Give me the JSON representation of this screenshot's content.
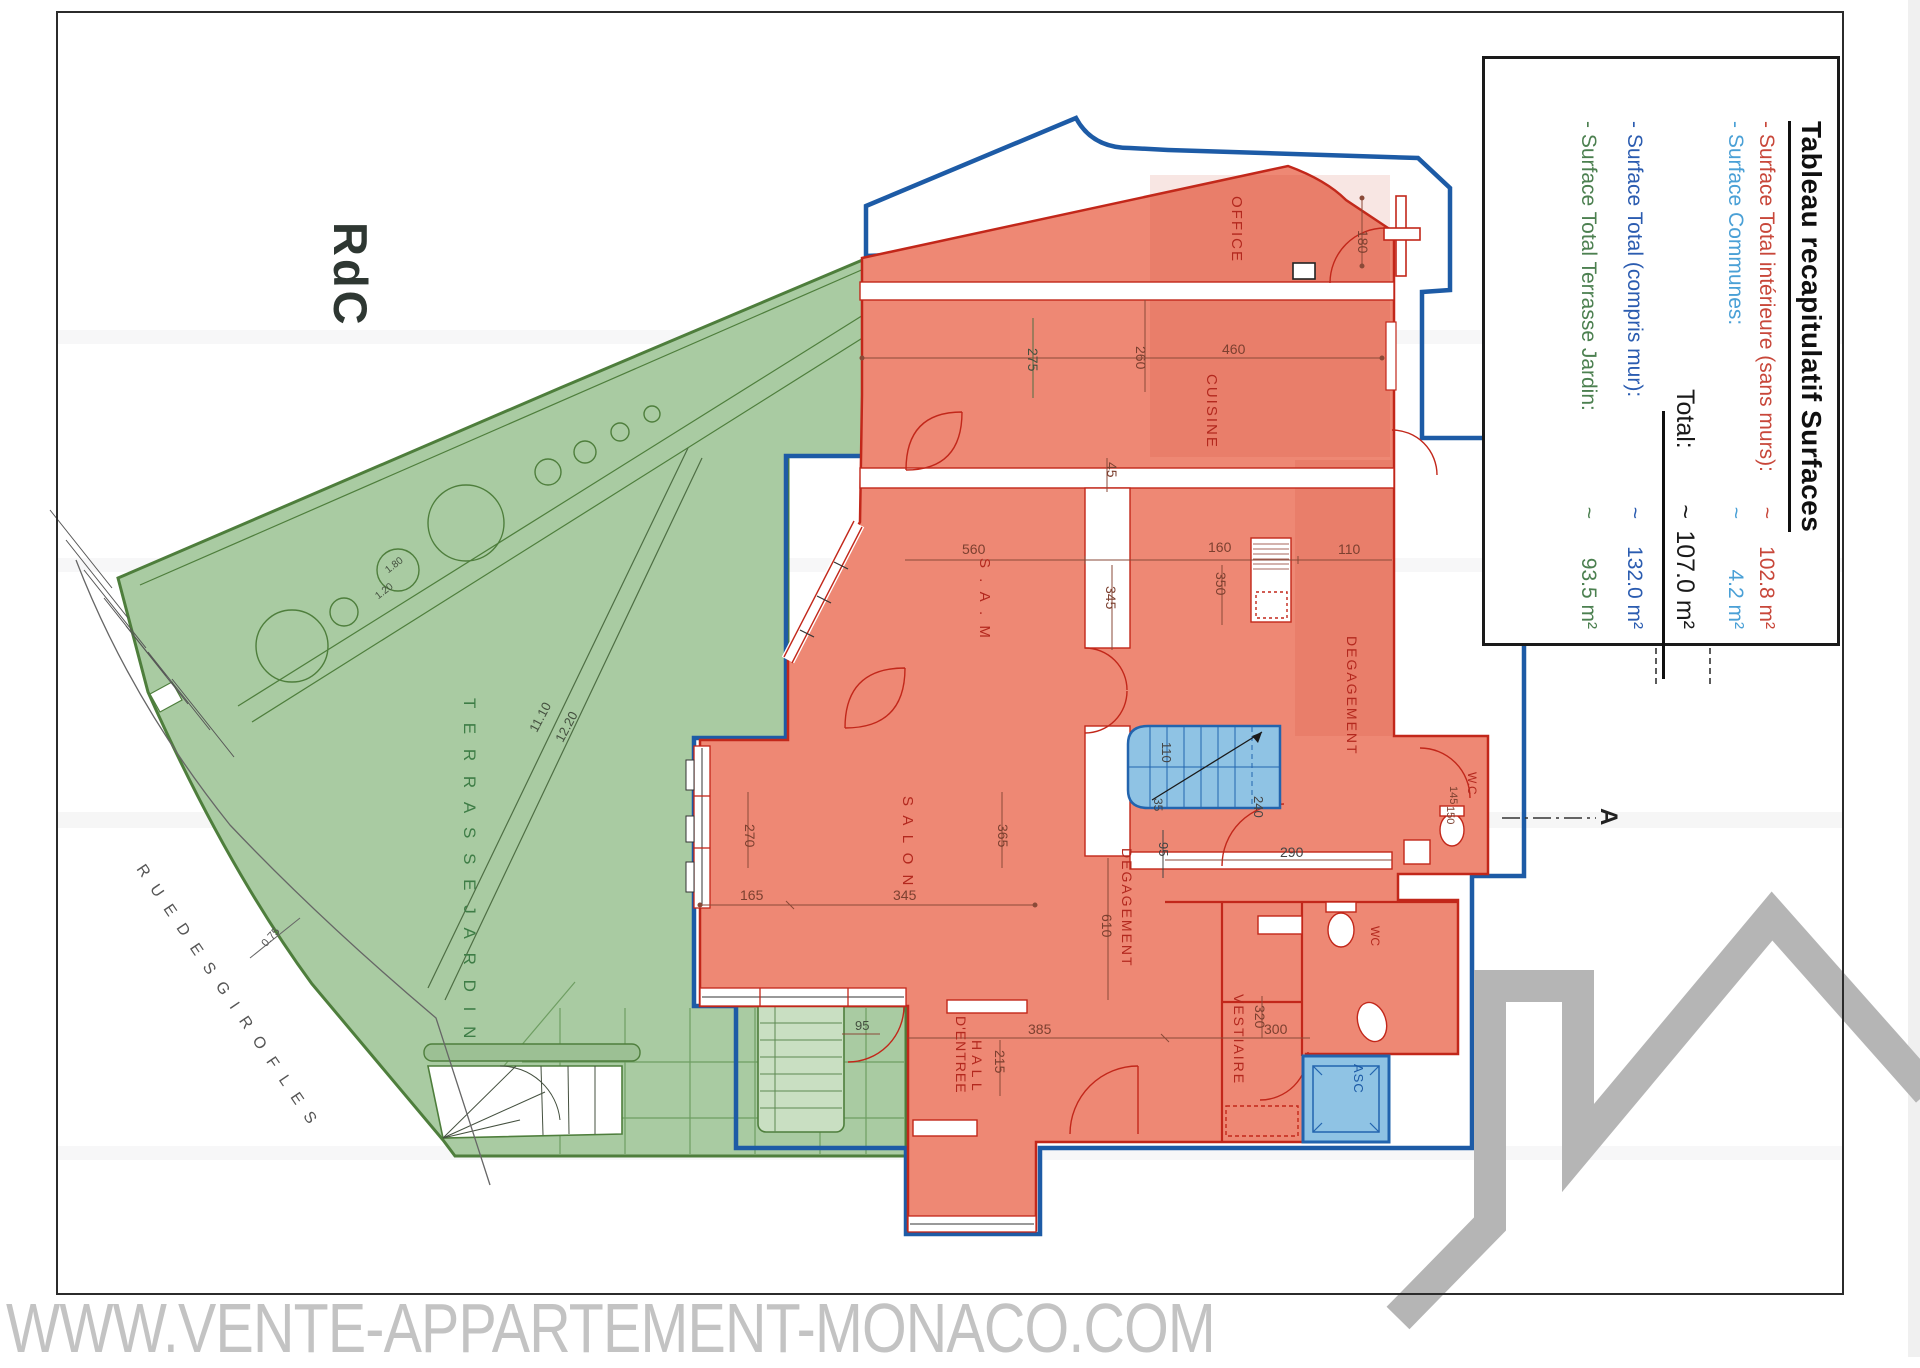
{
  "page": {
    "rdc_label": "RdC",
    "watermark": "WWW.VENTE-APPARTEMENT-MONACO.COM"
  },
  "legend": {
    "title": "Tableau recapitulatif Surfaces",
    "rows": [
      {
        "label": "- Surface Total intérieure (sans murs):",
        "approx": "~",
        "value": "102.8 m²",
        "color": "#c8473a"
      },
      {
        "label": "- Surface Communes:",
        "approx": "~",
        "value": "4.2 m²",
        "color": "#4aa0d6"
      },
      {
        "label": "Total:",
        "approx": "~",
        "value": "107.0 m²",
        "color": "#1a1a1a"
      },
      {
        "label": "- Surface Total (compris mur):",
        "approx": "~",
        "value": "132.0 m²",
        "color": "#2b5cb0"
      },
      {
        "label": "- Surface Total Terrasse Jardin:",
        "approx": "~",
        "value": "93.5 m²",
        "color": "#4c8050"
      }
    ]
  },
  "plan": {
    "labels": [
      {
        "id": "room-office",
        "t": "OFFICE",
        "x": 1244,
        "y": 196,
        "r": 90,
        "s": 15,
        "c": "#b3281e",
        "ls": 2
      },
      {
        "id": "room-cuisine",
        "t": "CUISINE",
        "x": 1219,
        "y": 374,
        "r": 90,
        "s": 15,
        "c": "#b3281e",
        "ls": 2
      },
      {
        "id": "room-sam",
        "t": "S . A . M",
        "x": 992,
        "y": 558,
        "r": 90,
        "s": 15,
        "c": "#b3281e",
        "ls": 3
      },
      {
        "id": "room-salon",
        "t": "S A L O N",
        "x": 915,
        "y": 796,
        "r": 90,
        "s": 15,
        "c": "#b3281e",
        "ls": 3
      },
      {
        "id": "room-degagement-right",
        "t": "DEGAGEMENT",
        "x": 1359,
        "y": 636,
        "r": 90,
        "s": 14,
        "c": "#b3281e",
        "ls": 2
      },
      {
        "id": "room-degagement-bottom",
        "t": "DEGAGEMENT",
        "x": 1134,
        "y": 848,
        "r": 90,
        "s": 14,
        "c": "#b3281e",
        "ls": 2
      },
      {
        "id": "dim-610",
        "t": "610",
        "x": 1114,
        "y": 914,
        "r": 90,
        "s": 14,
        "c": "#7c4030"
      },
      {
        "id": "room-hall",
        "t": "H A L L",
        "x": 984,
        "y": 1040,
        "r": 90,
        "s": 14,
        "c": "#b3281e",
        "ls": 1
      },
      {
        "id": "room-hall-entree",
        "t": "D'ENTREE",
        "x": 968,
        "y": 1016,
        "r": 90,
        "s": 14,
        "c": "#b3281e",
        "ls": 1
      },
      {
        "id": "room-vestiaire",
        "t": "VESTIAIRE",
        "x": 1246,
        "y": 994,
        "r": 90,
        "s": 14,
        "c": "#b3281e",
        "ls": 2
      },
      {
        "id": "room-asc",
        "t": "ASC",
        "x": 1365,
        "y": 1064,
        "r": 90,
        "s": 13,
        "c": "#1d5ba6",
        "ls": 1
      },
      {
        "id": "room-wc-mid",
        "t": "W.C",
        "x": 1478,
        "y": 772,
        "r": 90,
        "s": 12,
        "c": "#b3281e"
      },
      {
        "id": "room-wc-bottom",
        "t": "WC",
        "x": 1381,
        "y": 926,
        "r": 90,
        "s": 12,
        "c": "#b3281e"
      },
      {
        "id": "terrace-label",
        "t": "T E R R A S S E   J A R D I N",
        "x": 478,
        "y": 698,
        "r": 90,
        "s": 17,
        "c": "#3e7d46",
        "ls": 5
      },
      {
        "id": "street-label",
        "t": "R U E   D E S   G I R O F L E S",
        "x": 146,
        "y": 862,
        "r": 56,
        "s": 16,
        "c": "#555555",
        "ls": 4
      },
      {
        "id": "section-a",
        "t": "A",
        "x": 1620,
        "y": 808,
        "r": 90,
        "s": 24,
        "c": "#222222",
        "b": 1
      },
      {
        "id": "dim-180",
        "t": "180",
        "x": 1370,
        "y": 230,
        "r": 90,
        "s": 14,
        "c": "#7c4030"
      },
      {
        "id": "dim-260",
        "t": "260",
        "x": 1148,
        "y": 346,
        "r": 90,
        "s": 14,
        "c": "#7c4030"
      },
      {
        "id": "dim-275",
        "t": "275",
        "x": 1040,
        "y": 348,
        "r": 90,
        "s": 14,
        "c": "#44503f"
      },
      {
        "id": "dim-45",
        "t": "45",
        "x": 1119,
        "y": 462,
        "r": 90,
        "s": 14,
        "c": "#7c4030"
      },
      {
        "id": "dim-345-v",
        "t": "345",
        "x": 1118,
        "y": 586,
        "r": 90,
        "s": 14,
        "c": "#7c4030"
      },
      {
        "id": "dim-350",
        "t": "350",
        "x": 1228,
        "y": 572,
        "r": 90,
        "s": 14,
        "c": "#7c4030"
      },
      {
        "id": "dim-270",
        "t": "270",
        "x": 757,
        "y": 824,
        "r": 90,
        "s": 14,
        "c": "#7c4030"
      },
      {
        "id": "dim-365",
        "t": "365",
        "x": 1010,
        "y": 824,
        "r": 90,
        "s": 14,
        "c": "#7c4030"
      },
      {
        "id": "dim-215",
        "t": "215",
        "x": 1007,
        "y": 1050,
        "r": 90,
        "s": 14,
        "c": "#7c4030"
      },
      {
        "id": "dim-320",
        "t": "320",
        "x": 1267,
        "y": 1005,
        "r": 90,
        "s": 14,
        "c": "#7c4030"
      },
      {
        "id": "dim-110-stairs",
        "t": "110",
        "x": 1173,
        "y": 742,
        "r": 90,
        "s": 13,
        "c": "#444444"
      },
      {
        "id": "dim-35",
        "t": "35",
        "x": 1164,
        "y": 798,
        "r": 90,
        "s": 12,
        "c": "#444444"
      },
      {
        "id": "dim-240",
        "t": "240",
        "x": 1265,
        "y": 796,
        "r": 90,
        "s": 13,
        "c": "#444444"
      },
      {
        "id": "dim-95-stairs",
        "t": "95",
        "x": 1170,
        "y": 842,
        "r": 90,
        "s": 13,
        "c": "#444444"
      },
      {
        "id": "dim-145",
        "t": "145",
        "x": 1458,
        "y": 786,
        "r": 90,
        "s": 11,
        "c": "#7c4030"
      },
      {
        "id": "dim-150",
        "t": "150",
        "x": 1455,
        "y": 806,
        "r": 90,
        "s": 11,
        "c": "#7c4030"
      },
      {
        "id": "dim-460",
        "t": "460",
        "x": 1222,
        "y": 342,
        "r": 0,
        "s": 14,
        "c": "#7c4030"
      },
      {
        "id": "dim-560",
        "t": "560",
        "x": 962,
        "y": 542,
        "r": 0,
        "s": 14,
        "c": "#7c4030"
      },
      {
        "id": "dim-160",
        "t": "160",
        "x": 1208,
        "y": 540,
        "r": 0,
        "s": 14,
        "c": "#7c4030"
      },
      {
        "id": "dim-110-kitchen",
        "t": "110",
        "x": 1338,
        "y": 542,
        "r": 0,
        "s": 14,
        "c": "#7c4030"
      },
      {
        "id": "dim-165",
        "t": "165",
        "x": 740,
        "y": 888,
        "r": 0,
        "s": 14,
        "c": "#7c4030"
      },
      {
        "id": "dim-345-h",
        "t": "345",
        "x": 893,
        "y": 888,
        "r": 0,
        "s": 14,
        "c": "#7c4030"
      },
      {
        "id": "dim-290",
        "t": "290",
        "x": 1280,
        "y": 845,
        "r": 0,
        "s": 14,
        "c": "#444444"
      },
      {
        "id": "dim-385",
        "t": "385",
        "x": 1028,
        "y": 1022,
        "r": 0,
        "s": 14,
        "c": "#7c4030"
      },
      {
        "id": "dim-300",
        "t": "300",
        "x": 1264,
        "y": 1022,
        "r": 0,
        "s": 14,
        "c": "#7c4030"
      },
      {
        "id": "dim-95-terrace",
        "t": "95",
        "x": 855,
        "y": 1019,
        "r": 0,
        "s": 13,
        "c": "#44503f"
      },
      {
        "id": "dim-12-20",
        "t": "12.20",
        "x": 553,
        "y": 738,
        "r": -62,
        "s": 13,
        "c": "#44503f"
      },
      {
        "id": "dim-11-10",
        "t": "11.10",
        "x": 527,
        "y": 728,
        "r": -62,
        "s": 13,
        "c": "#44503f"
      },
      {
        "id": "dim-1-80",
        "t": "1.80",
        "x": 384,
        "y": 568,
        "r": -38,
        "s": 10,
        "c": "#44503f"
      },
      {
        "id": "dim-1-20",
        "t": "1.20",
        "x": 374,
        "y": 594,
        "r": -38,
        "s": 10,
        "c": "#44503f"
      },
      {
        "id": "dim-0-75",
        "t": "0.75",
        "x": 260,
        "y": 942,
        "r": -48,
        "s": 11,
        "c": "#555555"
      }
    ]
  },
  "colors": {
    "terrace_fill": "#a9cba2",
    "terrace_line": "#4e7e3c",
    "apartment_fill": "#ee8874",
    "apartment_outline": "#c2271a",
    "common_outline": "#1d5ba6",
    "stairs_fill": "#8fc3e4",
    "logo_grey": "#b5b5b5"
  }
}
